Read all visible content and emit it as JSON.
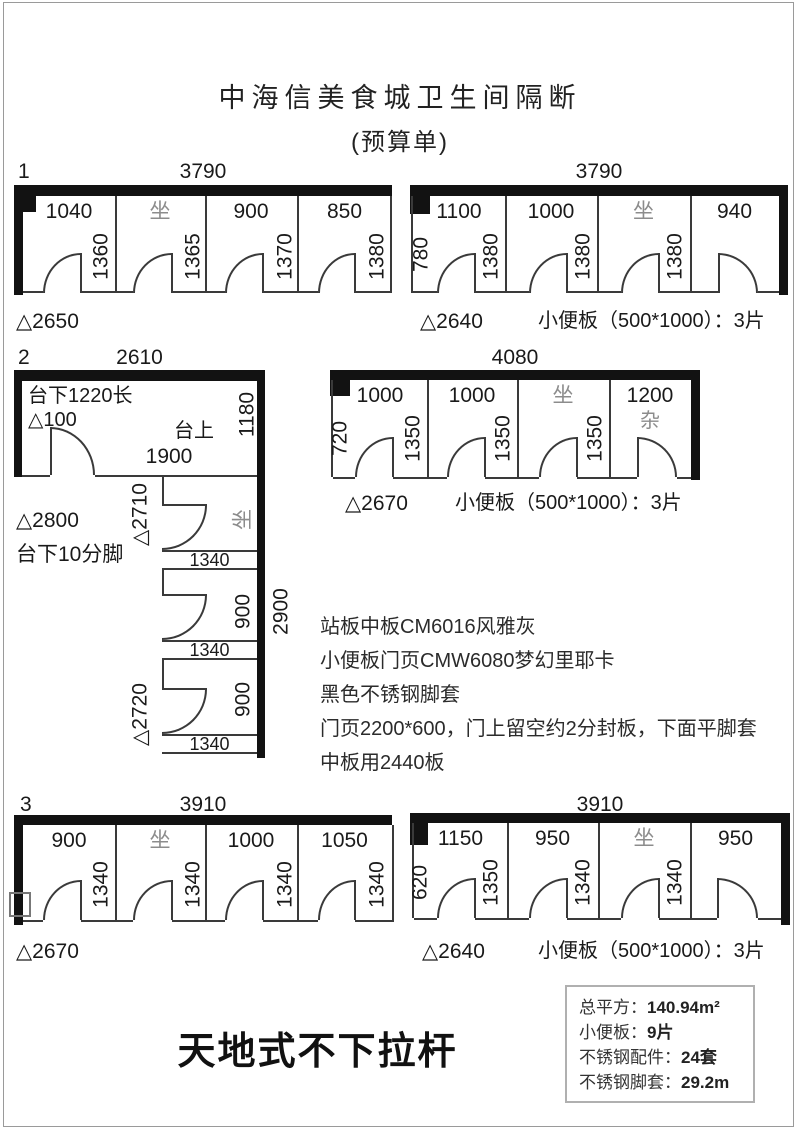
{
  "page": {
    "title": "中海信美食城卫生间隔断",
    "subtitle": "(预算单)",
    "footer": "天地式不下拉杆"
  },
  "diagrams": {
    "d1": {
      "index": "1",
      "top_dim": "3790",
      "height_note": "△2650",
      "stalls": [
        "1040",
        "坐",
        "900",
        "850"
      ],
      "doors": [
        "1360",
        "1365",
        "1370",
        "1380"
      ]
    },
    "tr": {
      "top_dim": "3790",
      "left_dim": "780",
      "height_note": "△2640",
      "stalls": [
        "1100",
        "1000",
        "坐",
        "940"
      ],
      "doors": [
        "1380",
        "1380",
        "1380"
      ],
      "urinal_note": "小便板（500*1000）：3片"
    },
    "d2": {
      "index": "2",
      "top_dim": "2610",
      "under_counter": "台下1220长",
      "delta100": "△100",
      "counter_top": "台上",
      "right_top_dim": "1180",
      "mid_dim": "1900",
      "delta2800": "△2800",
      "feet_note": "台下10分脚",
      "delta2710": "△2710",
      "delta2720": "△2720",
      "right_total_dim": "2900",
      "stalls": [
        {
          "side": "坐",
          "door": "1340"
        },
        {
          "side": "900",
          "door": "1340"
        },
        {
          "side": "900",
          "door": "1340"
        }
      ]
    },
    "mr": {
      "top_dim": "4080",
      "left_dim": "720",
      "height_note": "△2670",
      "stalls": [
        "1000",
        "1000",
        "坐",
        "1200"
      ],
      "extra_label": "杂",
      "doors": [
        "1350",
        "1350",
        "1350"
      ],
      "urinal_note": "小便板（500*1000）：3片"
    },
    "bl": {
      "index": "3",
      "top_dim": "3910",
      "height_note": "△2670",
      "stalls": [
        "900",
        "坐",
        "1000",
        "1050"
      ],
      "doors": [
        "1340",
        "1340",
        "1340",
        "1340"
      ]
    },
    "br": {
      "top_dim": "3910",
      "left_dim": "620",
      "height_note": "△2640",
      "stalls": [
        "1150",
        "950",
        "坐",
        "950"
      ],
      "doors": [
        "1350",
        "1340",
        "1340"
      ],
      "urinal_note": "小便板（500*1000）：3片"
    }
  },
  "notes": [
    "站板中板CM6016风雅灰",
    "小便板门页CMW6080梦幻里耶卡",
    "黑色不锈钢脚套",
    "门页2200*600，门上留空约2分封板，下面平脚套",
    "中板用2440板"
  ],
  "summary": {
    "rows": [
      {
        "label": "总平方：",
        "value": "140.94m²"
      },
      {
        "label": "小便板：",
        "value": "9片"
      },
      {
        "label": "不锈钢配件：",
        "value": "24套"
      },
      {
        "label": "不锈钢脚套：",
        "value": "29.2m"
      }
    ]
  }
}
